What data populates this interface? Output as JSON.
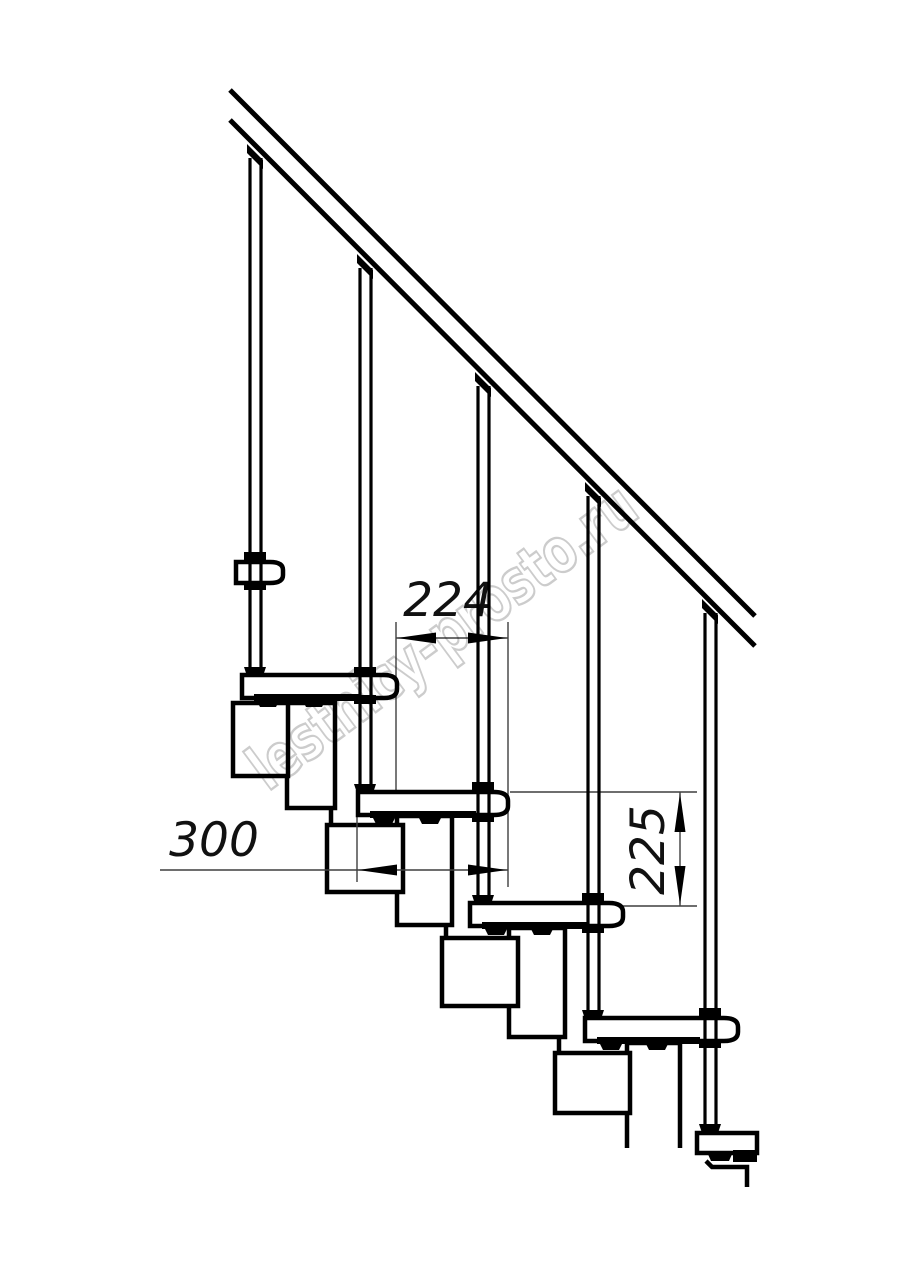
{
  "drawing": {
    "watermark_text": "lestnicy-prosto.ru",
    "dimensions": {
      "going": "224",
      "tread_depth": "300",
      "riser": "225"
    },
    "colors": {
      "line": "#000000",
      "dim_line": "#3f3f3f",
      "watermark": "#c7c7c7",
      "background": "#ffffff"
    }
  }
}
